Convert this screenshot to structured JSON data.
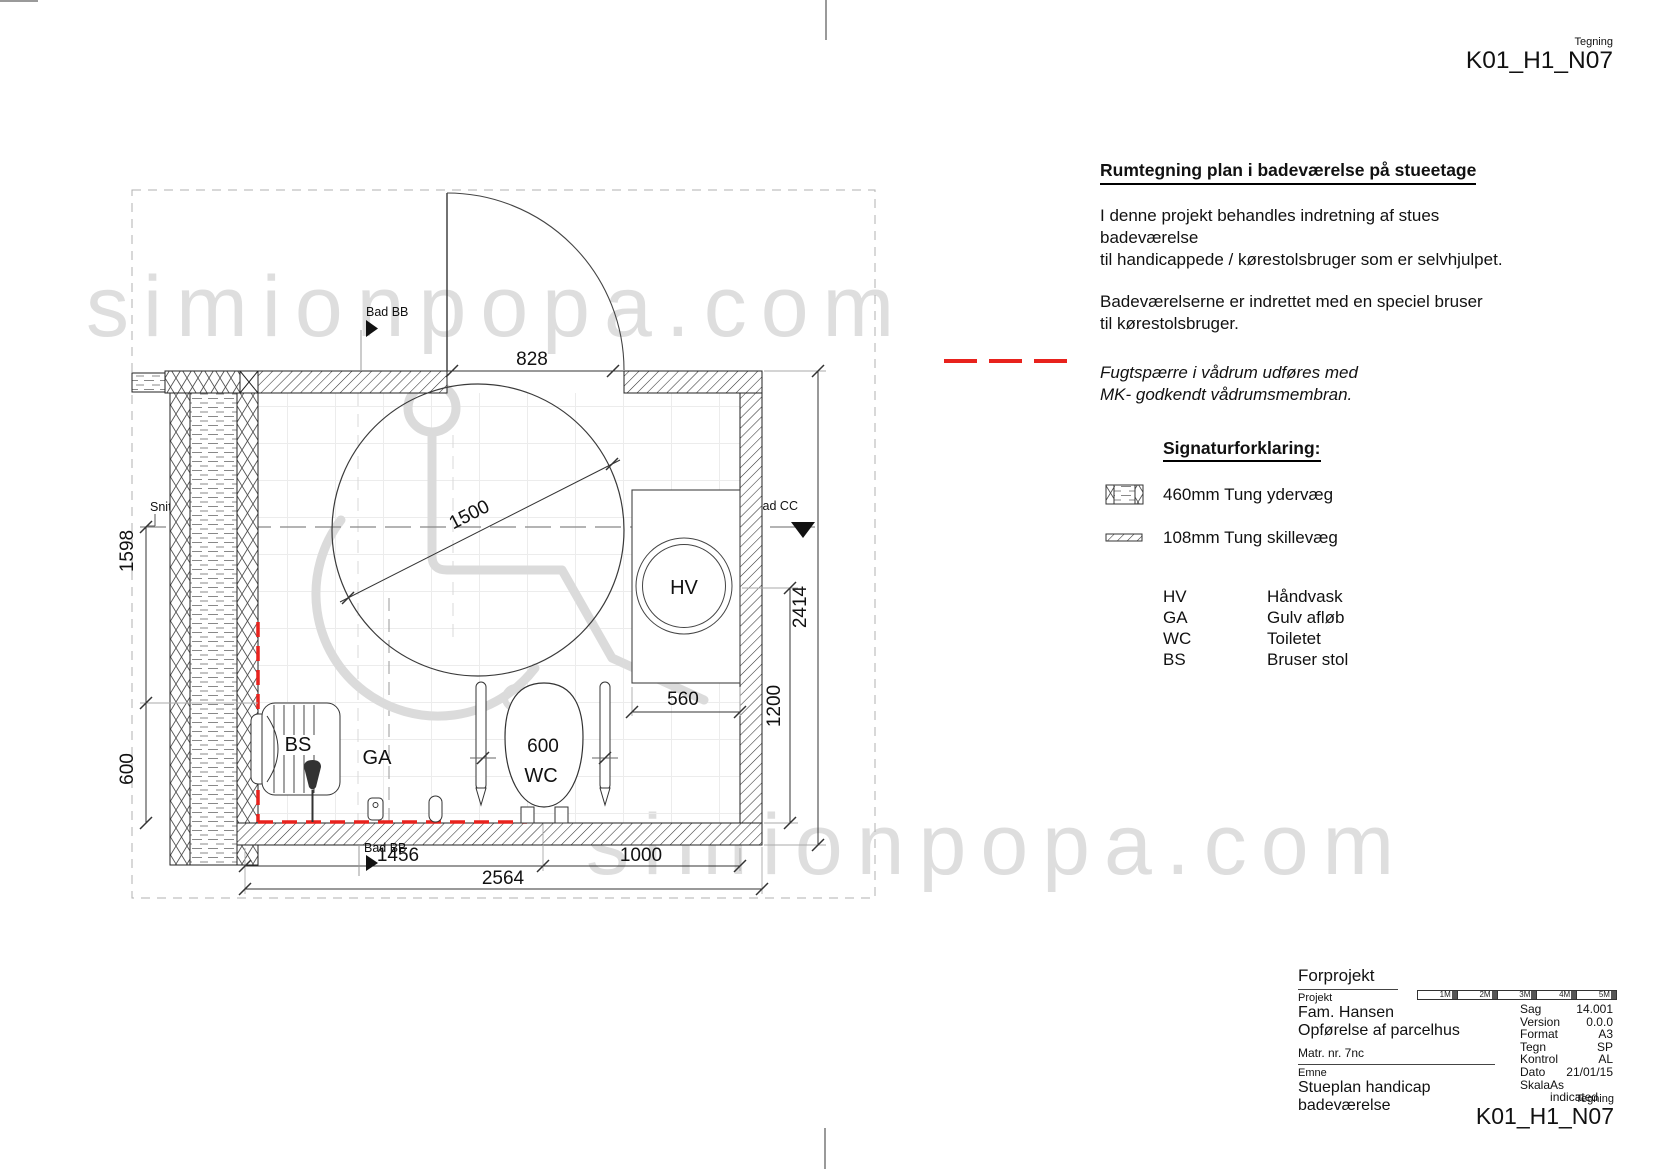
{
  "header": {
    "tegning_label": "Tegning",
    "drawing_no": "K01_H1_N07"
  },
  "notes": {
    "title": "Rumtegning plan i badeværelse på stueetage",
    "para1_line1": "I denne projekt behandles indretning af stues badeværelse",
    "para1_line2": "til handicappede / kørestolsbruger som er selvhjulpet.",
    "para2_line1": "Badeværelserne er indrettet med en speciel bruser",
    "para2_line2": "til kørestolsbruger.",
    "membrane_line1": "Fugtspærre i vådrum udføres med",
    "membrane_line2": "MK- godkendt vådrumsmembran."
  },
  "legend": {
    "title": "Signaturforklaring:",
    "items": [
      {
        "label": "460mm Tung ydervæg"
      },
      {
        "label": "108mm Tung skillevæg"
      }
    ],
    "abbreviations": [
      {
        "abbr": "HV",
        "label": "Håndvask"
      },
      {
        "abbr": "GA",
        "label": "Gulv afløb"
      },
      {
        "abbr": "WC",
        "label": "Toiletet"
      },
      {
        "abbr": "BS",
        "label": "Bruser stol"
      }
    ]
  },
  "plan": {
    "dims": {
      "door": "828",
      "turning_circle": "1500",
      "left_upper": "1598",
      "left_lower": "600",
      "vanity_width": "560",
      "room_outer": "2414",
      "basin_to_wall": "1200",
      "wc_rails": "600",
      "bottom_left": "1456",
      "bottom_right": "1000",
      "bottom_total": "2564"
    },
    "labels": {
      "hv": "HV",
      "ga": "GA",
      "wc": "WC",
      "bs": "BS",
      "bad_bb": "Bad BB",
      "snit_cc": "Snit bad CC"
    }
  },
  "watermark": {
    "text": "simionpopa.com"
  },
  "titleblock": {
    "phase": "Forprojekt",
    "projekt_label": "Projekt",
    "project_line1": "Fam. Hansen",
    "project_line2": "Opførelse af parcelhus",
    "matr": "Matr. nr. 7nc",
    "emne_label": "Emne",
    "emne_line1": "Stueplan handicap",
    "emne_line2": "badeværelse",
    "tegning_label": "Tegning",
    "drawing_no": "K01_H1_N07",
    "scalebar": [
      "1M",
      "2M",
      "3M",
      "4M",
      "5M"
    ],
    "fields": [
      {
        "label": "Sag",
        "value": "14.001"
      },
      {
        "label": "Version",
        "value": "0.0.0"
      },
      {
        "label": "Format",
        "value": "A3"
      },
      {
        "label": "Tegn",
        "value": "SP"
      },
      {
        "label": "Kontrol",
        "value": "AL"
      },
      {
        "label": "Dato",
        "value": "21/01/15"
      },
      {
        "label": "Skala",
        "value": "As indicated"
      }
    ]
  },
  "colors": {
    "accent_red": "#e8221d",
    "line": "#222222",
    "watermark": "#dedede"
  }
}
